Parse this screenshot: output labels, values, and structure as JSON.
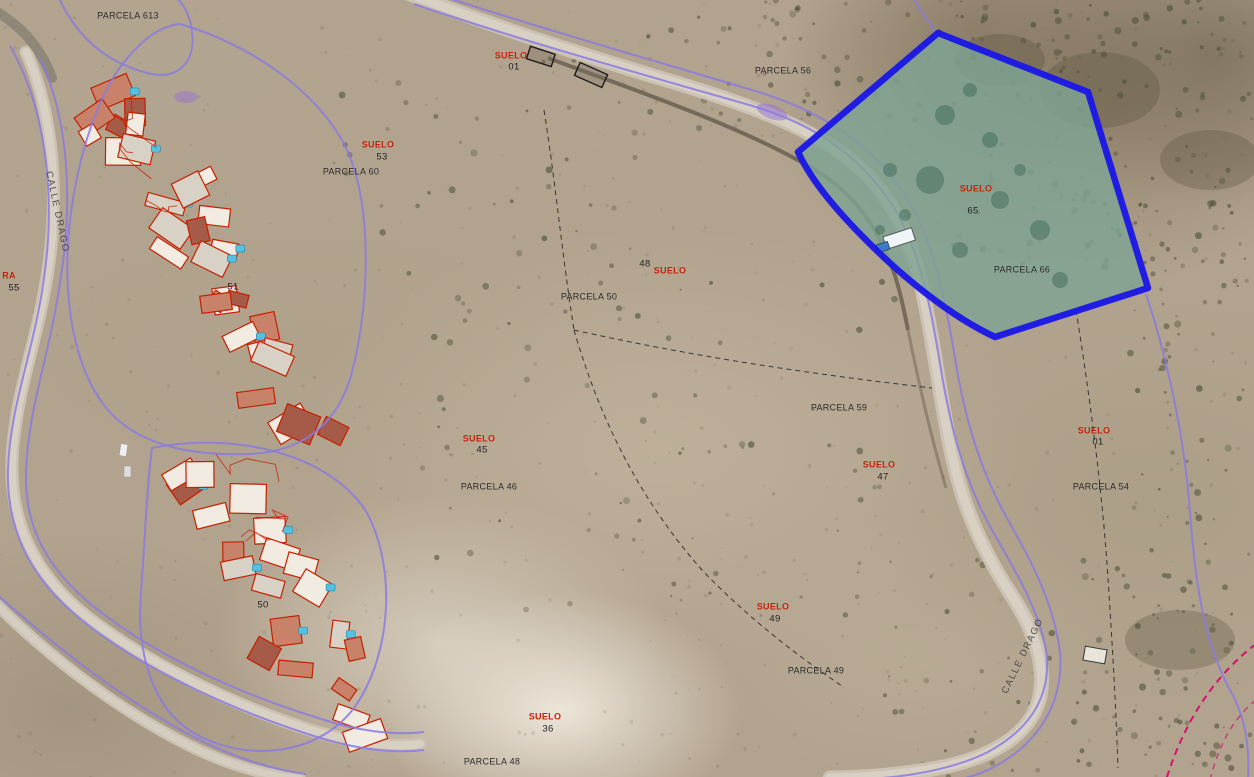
{
  "map": {
    "type": "cadastral-aerial-overlay",
    "highlighted_parcel": {
      "label": "PARCELA 66",
      "suelo_label": "SUELO",
      "number": "65"
    },
    "colors": {
      "highlight_stroke": "#1a16e8",
      "highlight_fill": "#7fa393",
      "boundary_purple": "#8a7ae0",
      "building_outline_red": "#c42000",
      "suelo_red": "#c21a00",
      "dashed_boundary_black": "#222222",
      "pink_boundary": "#d6116e",
      "label_dark": "#1b1b1b"
    },
    "labels": [
      {
        "text": "PARCELA 613",
        "x": 128,
        "y": 16,
        "kind": "parcel"
      },
      {
        "text": "SUELO",
        "x": 511,
        "y": 56,
        "kind": "suelo"
      },
      {
        "text": "01",
        "x": 514,
        "y": 67,
        "kind": "number"
      },
      {
        "text": "PARCELA 56",
        "x": 783,
        "y": 71,
        "kind": "parcel"
      },
      {
        "text": "SUELO",
        "x": 378,
        "y": 145,
        "kind": "suelo"
      },
      {
        "text": "53",
        "x": 382,
        "y": 157,
        "kind": "number"
      },
      {
        "text": "PARCELA 60",
        "x": 351,
        "y": 172,
        "kind": "parcel"
      },
      {
        "text": "SUELO",
        "x": 976,
        "y": 189,
        "kind": "suelo"
      },
      {
        "text": "65",
        "x": 973,
        "y": 211,
        "kind": "number"
      },
      {
        "text": "PARCELA 66",
        "x": 1022,
        "y": 270,
        "kind": "parcel"
      },
      {
        "text": "48",
        "x": 645,
        "y": 264,
        "kind": "number"
      },
      {
        "text": "SUELO",
        "x": 670,
        "y": 271,
        "kind": "suelo"
      },
      {
        "text": "PARCELA 50",
        "x": 589,
        "y": 297,
        "kind": "parcel"
      },
      {
        "text": "PARCELA 59",
        "x": 839,
        "y": 408,
        "kind": "parcel"
      },
      {
        "text": "SUELO",
        "x": 479,
        "y": 439,
        "kind": "suelo"
      },
      {
        "text": "45",
        "x": 482,
        "y": 450,
        "kind": "number"
      },
      {
        "text": "PARCELA 46",
        "x": 489,
        "y": 487,
        "kind": "parcel"
      },
      {
        "text": "SUELO",
        "x": 879,
        "y": 465,
        "kind": "suelo"
      },
      {
        "text": "47",
        "x": 883,
        "y": 477,
        "kind": "number"
      },
      {
        "text": "SUELO",
        "x": 1094,
        "y": 431,
        "kind": "suelo"
      },
      {
        "text": "01",
        "x": 1098,
        "y": 442,
        "kind": "number"
      },
      {
        "text": "PARCELA 54",
        "x": 1101,
        "y": 487,
        "kind": "parcel"
      },
      {
        "text": "SUELO",
        "x": 773,
        "y": 607,
        "kind": "suelo"
      },
      {
        "text": "49",
        "x": 775,
        "y": 619,
        "kind": "number"
      },
      {
        "text": "PARCELA 49",
        "x": 816,
        "y": 671,
        "kind": "parcel"
      },
      {
        "text": "SUELO",
        "x": 545,
        "y": 717,
        "kind": "suelo"
      },
      {
        "text": "36",
        "x": 548,
        "y": 729,
        "kind": "number"
      },
      {
        "text": "PARCELA 48",
        "x": 492,
        "y": 762,
        "kind": "parcel"
      },
      {
        "text": "RA",
        "x": 9,
        "y": 276,
        "kind": "fragment"
      },
      {
        "text": "55",
        "x": 14,
        "y": 288,
        "kind": "number"
      },
      {
        "text": "51",
        "x": 233,
        "y": 287,
        "kind": "number"
      },
      {
        "text": "50",
        "x": 263,
        "y": 605,
        "kind": "number"
      },
      {
        "text": "CALLE DRAGO",
        "x": 57,
        "y": 212,
        "kind": "street",
        "rot": 78
      },
      {
        "text": "CALLE DRAGO",
        "x": 1023,
        "y": 656,
        "kind": "street",
        "rot": -64
      }
    ]
  }
}
